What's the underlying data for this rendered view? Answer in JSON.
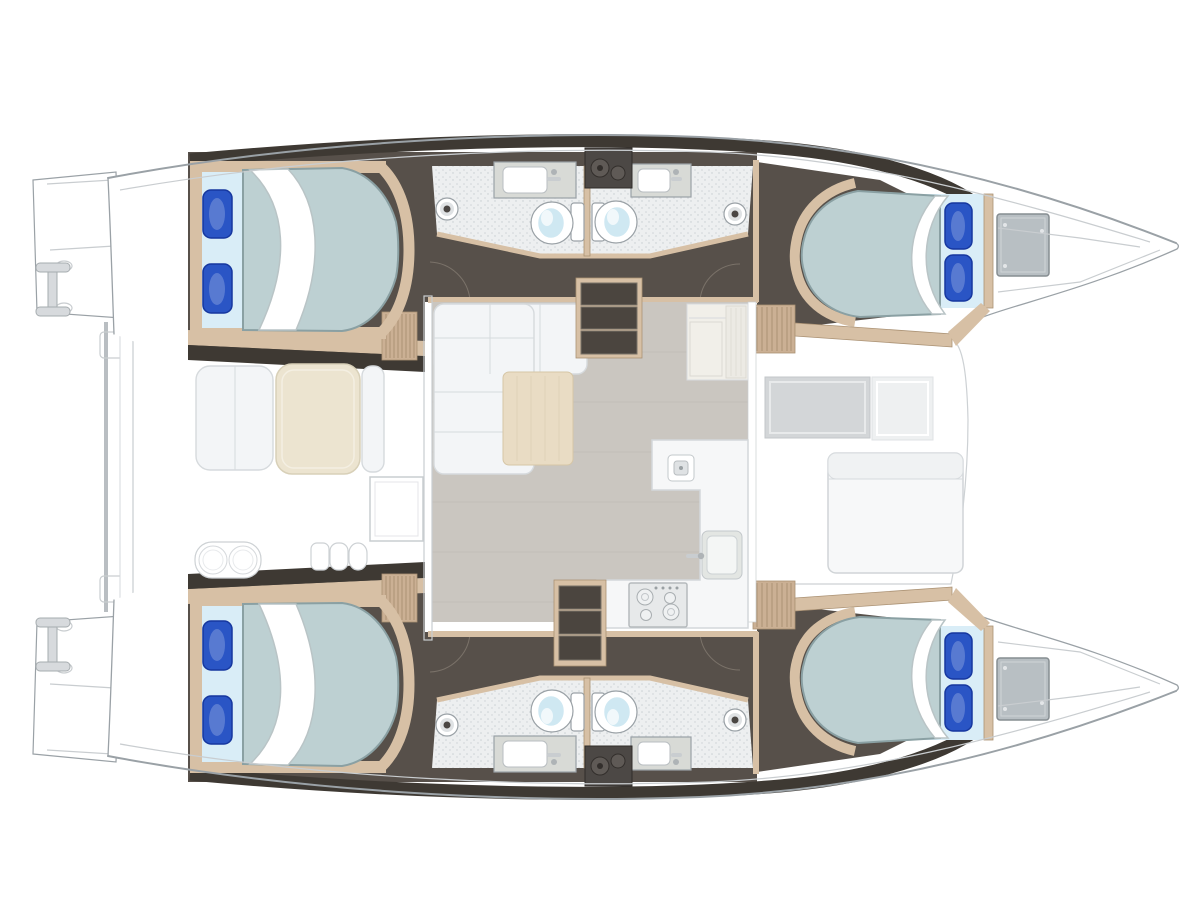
{
  "palette": {
    "white": "#ffffff",
    "outline": "#9aa1a6",
    "line_light": "#c9cdd0",
    "deck_white": "#ffffff",
    "deck_shade": "#eef0f1",
    "interior_dark": "#57504a",
    "interior_darker": "#3e3933",
    "wood": "#d7c0a5",
    "wood_dark": "#ab9274",
    "wood_floor": "#cbb094",
    "bath_floor": "#edeff0",
    "mattress": "#bdd0d2",
    "mattress_edge": "#8aa0a3",
    "sheet": "#d9edf7",
    "pillow": "#2a55c5",
    "pillow_dark": "#16379f",
    "toilet_lid": "#cfe8f2",
    "fixture_gray": "#d8dad6",
    "salon_floor": "#cac6c0",
    "sofa": "#f3f5f7",
    "sofa_line": "#d6dadd",
    "chaise": "#e9dcc4",
    "table_cream": "#ece4d0",
    "counter": "#f6f7f8",
    "stove": "#e7e9ea",
    "equip": "#4c4845",
    "equip_hi": "#5f5a56",
    "hatch": "#b8bfc3",
    "recess_gray": "#d3d6d8",
    "recess_light": "#eef0f1",
    "bench": "#f7f8f9",
    "cabinet": "#f1efe9",
    "steps_dark": "#4b453f",
    "beam_gray": "#ced2d5",
    "ladder_gray": "#d7dadd",
    "bowl_white": "#ffffff",
    "sink_inner": "#f4f6f5",
    "sink_body": "#e3e6e3"
  },
  "scene": {
    "title": "Catamaran interior layout plan (top view)",
    "orientation": {
      "bow": "right",
      "stern": "left"
    },
    "counts": {
      "cabins": 4,
      "double_berths": 4,
      "pillows_per_berth": 2,
      "heads": 4,
      "toilets": 4,
      "washbasins": 4,
      "shower_drains": 4,
      "boarding_ladders": 2,
      "anchor_locker_hatches": 2,
      "companionway_stairs": 2
    },
    "hulls": [
      {
        "side": "port-top",
        "spaces": [
          "transom platform with boarding ladder",
          "aft double cabin",
          "head with toilet and basin",
          "twin shared heads",
          "companionway corridor",
          "forward double cabin",
          "forepeak anchor locker"
        ]
      },
      {
        "side": "starboard-bottom",
        "spaces": [
          "transom platform with boarding ladder",
          "aft double cabin",
          "head with toilet and basin",
          "twin shared heads",
          "companionway corridor",
          "forward double cabin",
          "forepeak anchor locker"
        ]
      }
    ],
    "saloon": {
      "features": [
        "L-shaped sofa",
        "lounge pad",
        "storage cabinet",
        "L-shaped galley counter",
        "four-burner stove",
        "galley sink",
        "prep sink",
        "port companionway steps",
        "starboard companionway steps"
      ]
    },
    "cockpit": {
      "features": [
        "dining table",
        "bench seat",
        "side bench",
        "stowage box",
        "double stool seat",
        "fan steps",
        "davit beam"
      ]
    },
    "foredeck": {
      "features": [
        "sunken footwell",
        "lounge bench with backrest",
        "teak trim steps"
      ]
    }
  }
}
